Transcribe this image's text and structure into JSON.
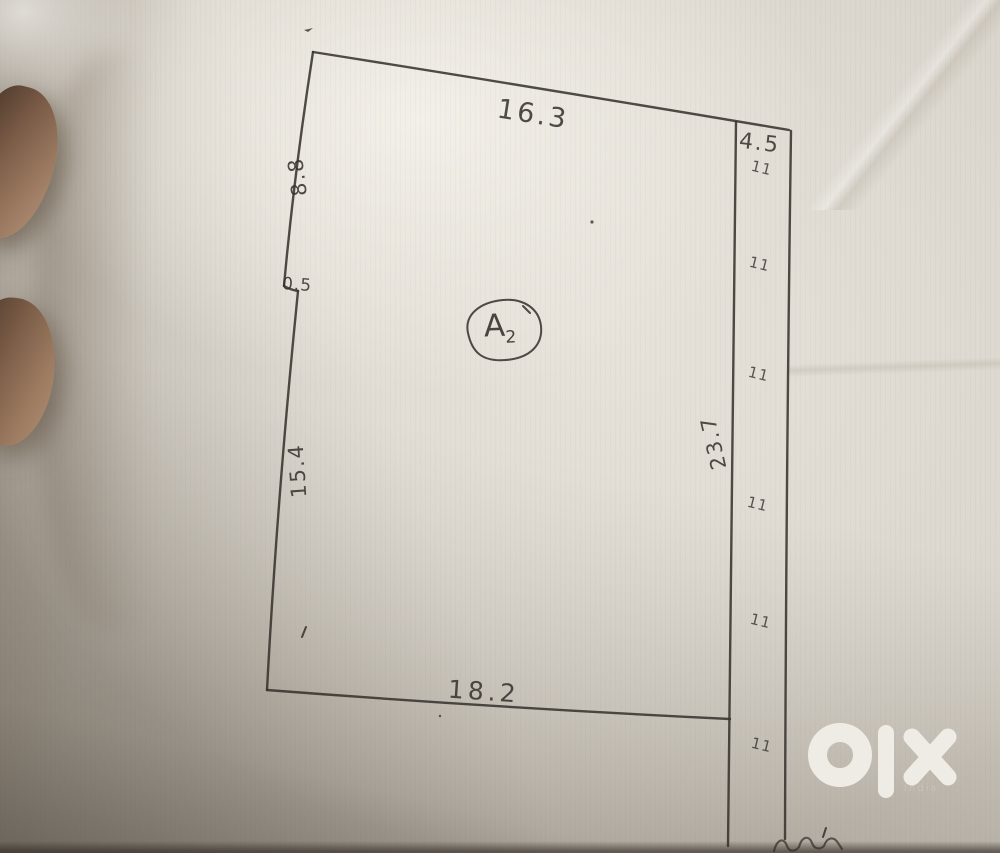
{
  "sketch": {
    "plot_label": {
      "main": "A",
      "subscript": "2"
    },
    "dimensions": {
      "top_edge": "16.3",
      "strip_top": "4.5",
      "left_upper_edge": "8.8",
      "left_notch": "0.5",
      "left_lower_edge": "15.4",
      "right_edge": "23.7",
      "bottom_edge": "18.2"
    },
    "ditto_mark": "11",
    "ink_color": "#38332d"
  },
  "watermark": {
    "brand_icon": "olx-logo",
    "subtext": "India",
    "color": "#f2efe9"
  },
  "paper": {
    "base_color": "#d8d3ca",
    "shadow_color": "#7c7266"
  }
}
